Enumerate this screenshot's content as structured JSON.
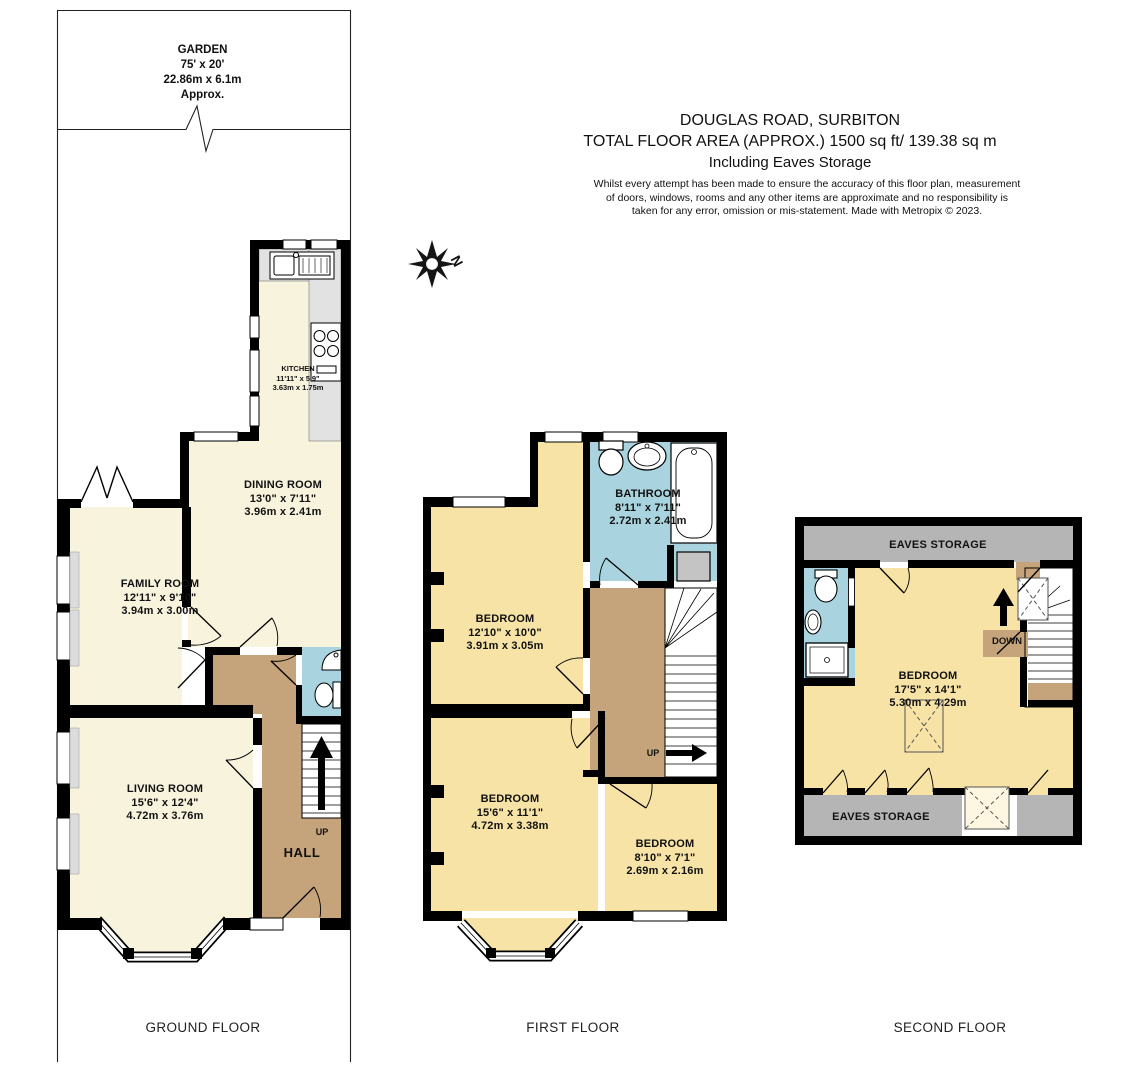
{
  "header": {
    "address": "DOUGLAS ROAD, SURBITON",
    "area_line": "TOTAL FLOOR AREA (APPROX.) 1500 sq ft/ 139.38 sq m",
    "includes_line": "Including Eaves Storage",
    "disclaimer": "Whilst every attempt has been made to ensure the accuracy of this floor plan, measurement of doors, windows, rooms and any other items are approximate and no responsibility is taken for any error, omission or mis-statement. Made with Metropix © 2023."
  },
  "compass": {
    "label": "N"
  },
  "garden": {
    "name": "GARDEN",
    "size_imperial": "75' x 20'",
    "size_metric": "22.86m x 6.1m",
    "note": "Approx."
  },
  "ground_floor": {
    "label": "GROUND FLOOR",
    "kitchen": {
      "name": "KITCHEN",
      "size_imperial": "11'11\" x 5'9\"",
      "size_metric": "3.63m x 1.75m"
    },
    "dining_room": {
      "name": "DINING ROOM",
      "size_imperial": "13'0\" x 7'11\"",
      "size_metric": "3.96m x 2.41m"
    },
    "family_room": {
      "name": "FAMILY ROOM",
      "size_imperial": "12'11\" x 9'10\"",
      "size_metric": "3.94m x 3.00m"
    },
    "living_room": {
      "name": "LIVING ROOM",
      "size_imperial": "15'6\" x 12'4\"",
      "size_metric": "4.72m x 3.76m"
    },
    "hall": {
      "name": "HALL"
    },
    "stairs_label": "UP"
  },
  "first_floor": {
    "label": "FIRST FLOOR",
    "bathroom": {
      "name": "BATHROOM",
      "size_imperial": "8'11\" x 7'11\"",
      "size_metric": "2.72m x 2.41m"
    },
    "bedroom_front": {
      "name": "BEDROOM",
      "size_imperial": "12'10\" x 10'0\"",
      "size_metric": "3.91m x 3.05m"
    },
    "bedroom_middle": {
      "name": "BEDROOM",
      "size_imperial": "15'6\" x 11'1\"",
      "size_metric": "4.72m x 3.38m"
    },
    "bedroom_small": {
      "name": "BEDROOM",
      "size_imperial": "8'10\" x 7'1\"",
      "size_metric": "2.69m x 2.16m"
    },
    "stairs_label": "UP"
  },
  "second_floor": {
    "label": "SECOND FLOOR",
    "bedroom": {
      "name": "BEDROOM",
      "size_imperial": "17'5\" x 14'1\"",
      "size_metric": "5.30m x 4.29m"
    },
    "eaves_top": "EAVES STORAGE",
    "eaves_bottom": "EAVES STORAGE",
    "stairs_label": "DOWN"
  },
  "colors": {
    "room_cream": "#F8F3DD",
    "room_yellow": "#F6E3A5",
    "hall_brown": "#C5A37B",
    "bath_blue": "#A9D4DF",
    "eaves_gray": "#B5B5B5",
    "counter_gray": "#E2E2E2",
    "wall_black": "#000000"
  }
}
